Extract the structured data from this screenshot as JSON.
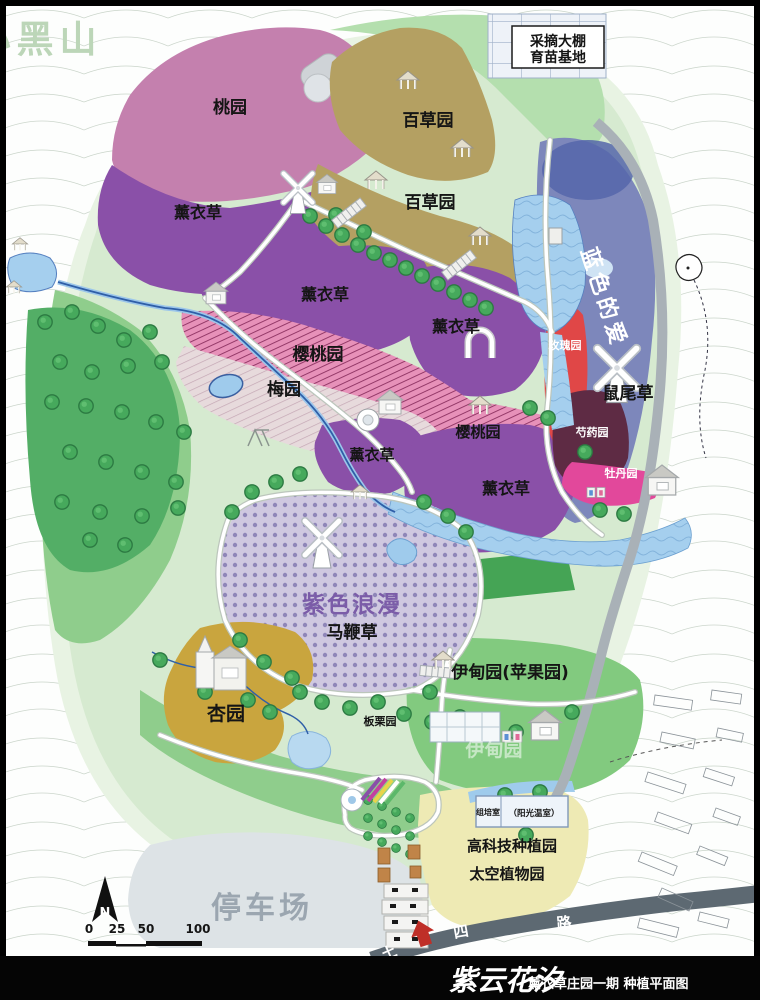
{
  "map": {
    "mountain": "小黑山",
    "nursery_box": {
      "line1": "采摘大棚",
      "line2": "育苗基地"
    },
    "areas": {
      "peach": "桃园",
      "herb": "百草园",
      "lavender": "薰衣草",
      "blue_love": "蓝色的爱",
      "sage": "鼠尾草",
      "rose": "玫瑰园",
      "peony": "芍药园",
      "tree_peony": "牡丹园",
      "cherry": "樱桃园",
      "plum": "梅园",
      "romance": "紫色浪漫",
      "verbena": "马鞭草",
      "eden": "伊甸园(苹果园)",
      "eden_watermark": "伊甸园",
      "chestnut": "板栗园",
      "apricot": "杏园",
      "tissue_room": "组培室",
      "sun_greenhouse": "（阳光温室）",
      "hightech": "高科技种植园",
      "space_garden": "太空植物园",
      "parking": "停车场"
    },
    "road": {
      "char1": "土",
      "char2": "四",
      "char3": "路"
    },
    "compass_label": "N",
    "scale_ticks": [
      "0",
      "25",
      "50",
      "100"
    ]
  },
  "titlebar": {
    "brand": "紫云花汐",
    "subtitle": "薰衣草庄园一期  种植平面图"
  },
  "palette": {
    "peach": "#c480ae",
    "lavender": "#8a50a8",
    "herb": "#b4a062",
    "blue_love": "#7d87bb",
    "blue_love_deep": "#5566aa",
    "rose": "#e04747",
    "peony": "#5e2b44",
    "tree_peony": "#e2489b",
    "cherry_bg": "#e791b9",
    "plum_bg": "#e7dadc",
    "verbena_bg": "#cfc8e0",
    "apricot": "#c9a53e",
    "water": "#a5cfee",
    "field_yellow": "#eeeab4",
    "parking": "#dde3e6",
    "road_dark": "#5d6972"
  }
}
